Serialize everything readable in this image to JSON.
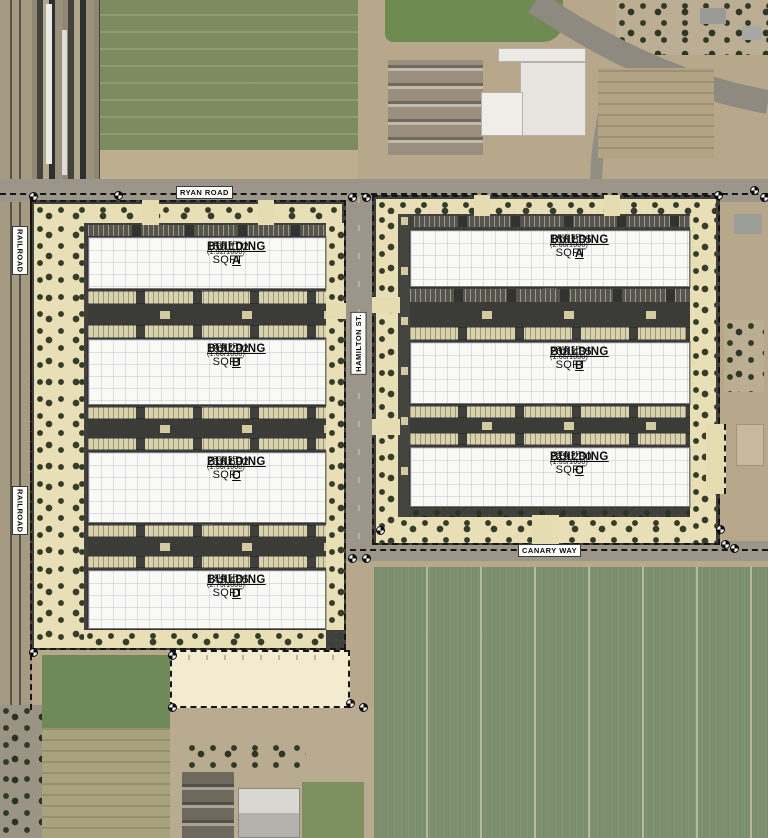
{
  "map": {
    "roads": {
      "ryan_road": "RYAN ROAD",
      "hamilton_st": "HAMILTON ST.",
      "canary_way": "CANARY WAY",
      "railroad_upper": "RAILROAD",
      "railroad_lower": "RAILROAD"
    },
    "parcels": {
      "left": {
        "buildings": [
          {
            "name": "BUILDING A",
            "sqft": "150,102 SQFT",
            "parking": "288 SP. (1.92/1000)"
          },
          {
            "name": "BUILDING B",
            "sqft": "199,292 SQFT",
            "parking": "329 SP. (1.66/1000)"
          },
          {
            "name": "BUILDING C",
            "sqft": "216,692 SQFT",
            "parking": "336 SP. (1.56/1000)"
          },
          {
            "name": "BUILDING D",
            "sqft": "149,485 SQFT",
            "parking": "410 SP. (2.75/1000)"
          }
        ]
      },
      "right": {
        "buildings": [
          {
            "name": "BUILDING A",
            "sqft": "166,835 SQFT",
            "parking": "446 SP. (2.68/1000)"
          },
          {
            "name": "BUILDING B",
            "sqft": "208,435 SQFT",
            "parking": "345 SP. (1.66/1000)"
          },
          {
            "name": "BUILDING C",
            "sqft": "229,230 SQFT",
            "parking": "355 SP. (1.55/1000)"
          }
        ]
      }
    },
    "colors": {
      "asphalt": "#3f3f3c",
      "landscape_tan": "#e9dfb6",
      "building_white": "#f9f9f6",
      "stall_beige": "#d9d2af",
      "field_green": "#7c8b60",
      "road_gray": "#9c968a",
      "boundary_black": "#151515"
    }
  }
}
